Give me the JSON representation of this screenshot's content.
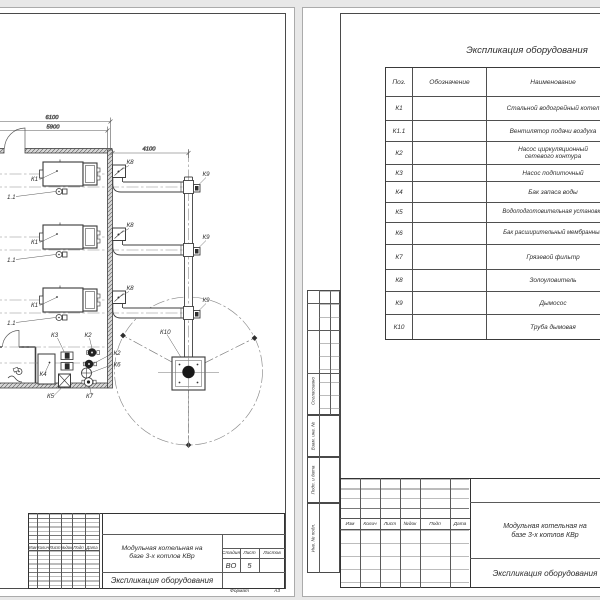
{
  "colors": {
    "background": "#e8e8e8",
    "paper": "#ffffff",
    "line": "#3f3f3f",
    "dark_fill": "#222222"
  },
  "left_sheet": {
    "plan": {
      "dimensions": {
        "width_total": "6100",
        "width_inner": "5900",
        "flue_offset": "4100"
      },
      "equipment_labels": {
        "boiler": "К1",
        "fan": "1.1",
        "network_pump": "К2",
        "makeup_pump": "К3",
        "storage_tank": "К4",
        "water_treatment": "К5",
        "expansion_tank": "К6",
        "mud_filter": "К7",
        "ash_catcher": "К8",
        "smoke_exhauster": "К9",
        "chimney": "К10"
      }
    },
    "title_block": {
      "rev_headers": [
        "Изм",
        "Колич",
        "Лист",
        "№док",
        "Подп",
        "Дата"
      ],
      "project_line1": "Модульная котельная на",
      "project_line2": "базе 3-х котлов КВр",
      "stage_label": "Стадия",
      "stage_value": "ВО",
      "sheet_label": "Лист",
      "sheet_value": "5",
      "sheets_label": "Листов",
      "doc_title": "Экспликация оборудования",
      "format_label": "Формат",
      "format_value": "А3"
    }
  },
  "right_sheet": {
    "sidebar": {
      "agreed": "Согласовано",
      "replace_inv": "Взам. инв. №",
      "sign_date": "Подп. и дата",
      "inv_no": "Инв. № подл."
    },
    "table": {
      "title": "Экспликация оборудования",
      "headers": [
        "Поз.",
        "Обозначение",
        "Наименование"
      ],
      "rows": [
        {
          "pos": "К1",
          "name": "Стальной водогрейный котел"
        },
        {
          "pos": "К1.1",
          "name": "Вентилятор подачи воздуха"
        },
        {
          "pos": "К2",
          "name": "Насос циркуляционный",
          "name2": "сетевого контура"
        },
        {
          "pos": "К3",
          "name": "Насос подпиточный"
        },
        {
          "pos": "К4",
          "name": "Бак запаса воды"
        },
        {
          "pos": "К5",
          "name": "Водоподготовительная установка"
        },
        {
          "pos": "К6",
          "name": "Бак расширительный мембранный"
        },
        {
          "pos": "К7",
          "name": "Грязевой фильтр"
        },
        {
          "pos": "К8",
          "name": "Золоуловитель"
        },
        {
          "pos": "К9",
          "name": "Дымосос"
        },
        {
          "pos": "К10",
          "name": "Труба дымовая"
        }
      ]
    },
    "title_block": {
      "rev_headers": [
        "Изм",
        "Колич",
        "Лист",
        "№док",
        "Подп",
        "Дата"
      ],
      "project_line1": "Модульная котельная на",
      "project_line2": "базе 3-х котлов КВр",
      "doc_title": "Экспликация оборудования"
    }
  }
}
